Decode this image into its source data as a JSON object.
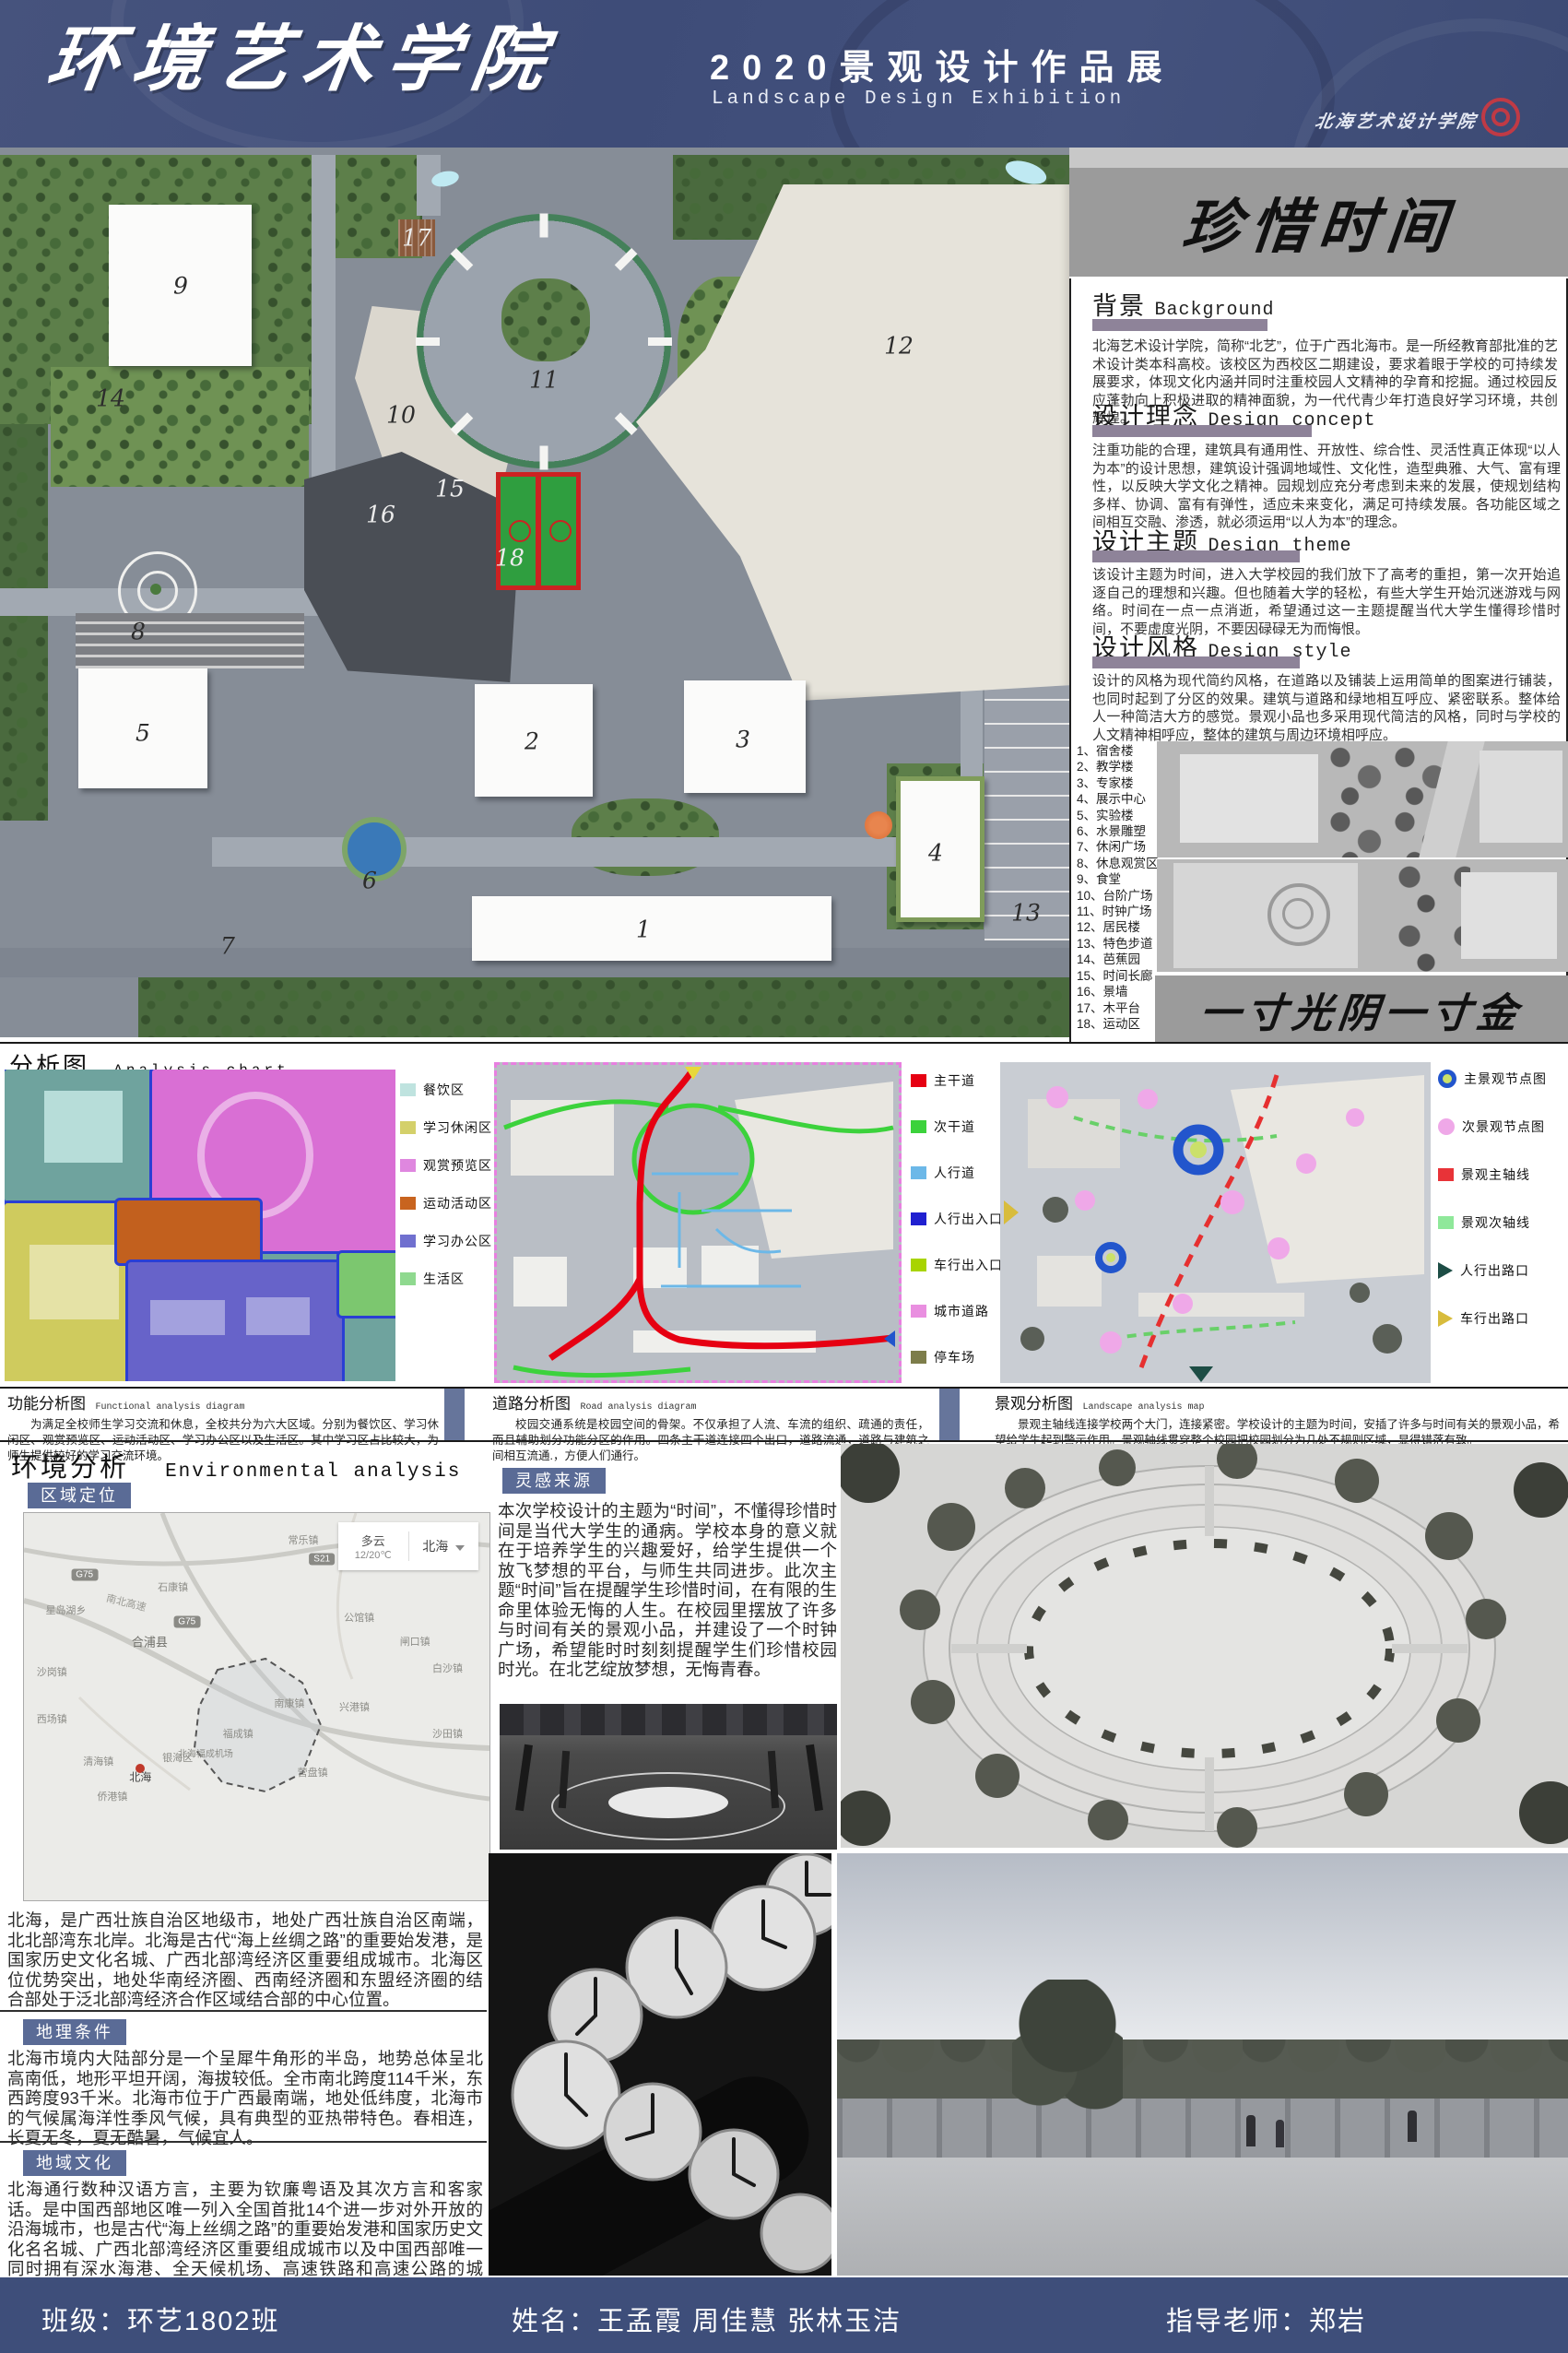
{
  "header": {
    "school_title": "环境艺术学院",
    "exhibition_title": "2020景观设计作品展",
    "exhibition_subtitle": "Landscape Design Exhibition",
    "logo_text": "北海艺术设计学院",
    "bg_color": "#3e4e78"
  },
  "theme": {
    "main_title": "珍惜时间",
    "motto": "一寸光阴一寸金"
  },
  "sections": {
    "background": {
      "title": "背景",
      "subtitle": "Background",
      "body": "北海艺术设计学院，简称“北艺”，位于广西北海市。是一所经教育部批准的艺术设计类本科高校。该校区为西校区二期建设，要求着眼于学校的可持续发展要求，体现文化内涵并同时注重校园人文精神的孕育和挖掘。通过校园反应蓬勃向上积极进取的精神面貌，为一代代青少年打造良好学习环境，共创辉煌。"
    },
    "concept": {
      "title": "设计理念",
      "subtitle": "Design concept",
      "body": "注重功能的合理，建筑具有通用性、开放性、综合性、灵活性真正体现“以人为本”的设计思想，建筑设计强调地域性、文化性，造型典雅、大气、富有理性，以反映大学文化之精神。园规划应充分考虑到未来的发展，使规划结构多样、协调、富有有弹性，适应未来变化，满足可持续发展。各功能区域之间相互交融、渗透，就必须运用“以人为本”的理念。"
    },
    "design_theme": {
      "title": "设计主题",
      "subtitle": "Design theme",
      "body": "该设计主题为时间，进入大学校园的我们放下了高考的重担，第一次开始追逐自己的理想和兴趣。但也随着大学的轻松，有些大学生开始沉迷游戏与网络。时间在一点一点消逝，希望通过这一主题提醒当代大学生懂得珍惜时间，不要虚度光阴，不要因碌碌无为而悔恨。"
    },
    "style": {
      "title": "设计风格",
      "subtitle": "Design style",
      "body": "设计的风格为现代简约风格，在道路以及铺装上运用简单的图案进行铺装，也同时起到了分区的效果。建筑与道路和绿地相互呼应、紧密联系。整体给人一种简洁大方的感觉。景观小品也多采用现代简洁的风格，同时与学校的人文精神相呼应，整体的建筑与周边环境相呼应。"
    }
  },
  "plan": {
    "markers": [
      "1",
      "2",
      "3",
      "4",
      "5",
      "6",
      "7",
      "8",
      "9",
      "10",
      "11",
      "12",
      "13",
      "14",
      "15",
      "16",
      "17",
      "18"
    ],
    "legend": [
      "1、宿舍楼",
      "2、教学楼",
      "3、专家楼",
      "4、展示中心",
      "5、实验楼",
      "6、水景雕塑",
      "7、休闲广场",
      "8、休息观赏区",
      "9、食堂",
      "10、台阶广场",
      "11、时钟广场",
      "12、居民楼",
      "13、特色步道",
      "14、芭蕉园",
      "15、时间长廊",
      "16、景墙",
      "17、木平台",
      "18、运动区"
    ]
  },
  "analysis": {
    "title": "分析图",
    "subtitle": "Analysis chart",
    "functional_legend": [
      {
        "label": "餐饮区",
        "color": "#bfe3df"
      },
      {
        "label": "学习休闲区",
        "color": "#d4d06a"
      },
      {
        "label": "观赏预览区",
        "color": "#df87df"
      },
      {
        "label": "运动活动区",
        "color": "#c8641f"
      },
      {
        "label": "学习办公区",
        "color": "#7070cf"
      },
      {
        "label": "生活区",
        "color": "#8fd98f"
      }
    ],
    "road_legend": [
      {
        "label": "主干道",
        "color": "#e60012"
      },
      {
        "label": "次干道",
        "color": "#3cd23c"
      },
      {
        "label": "人行道",
        "color": "#6cb8e8"
      },
      {
        "label": "人行出入口",
        "color": "#2020d0"
      },
      {
        "label": "车行出入口",
        "color": "#a8d400"
      },
      {
        "label": "城市道路",
        "color": "#e98fe0"
      },
      {
        "label": "停车场",
        "color": "#7d7d4a"
      }
    ],
    "landscape_legend": [
      {
        "label": "主景观节点图",
        "color": "#2255cc"
      },
      {
        "label": "次景观节点图",
        "color": "#efa8e8"
      },
      {
        "label": "景观主轴线",
        "color": "#e83338"
      },
      {
        "label": "景观次轴线",
        "color": "#8fe89a"
      },
      {
        "label": "人行出路口",
        "color": "#1d4d45"
      },
      {
        "label": "车行出路口",
        "color": "#d8bc3c"
      }
    ],
    "captions": [
      {
        "title": "功能分析图",
        "subtitle": "Functional analysis diagram",
        "body": "为满足全校师生学习交流和休息，全校共分为六大区域。分别为餐饮区、学习休闲区、观赏预览区、运动活动区、学习办公区以及生活区。其中学习区占比较大，为师生提供较好的学习交流环境。"
      },
      {
        "title": "道路分析图",
        "subtitle": "Road analysis diagram",
        "body": "校园交通系统是校园空间的骨架。不仅承担了人流、车流的组织、疏通的责任，而且辅助划分功能分区的作用。四条主干道连接四个出口，道路流通，道路与建筑之间相互流通.，方便人们通行。"
      },
      {
        "title": "景观分析图",
        "subtitle": "Landscape analysis map",
        "body": "景观主轴线连接学校两个大门，连接紧密。学校设计的主题为时间，安插了许多与时间有关的景观小品，希望给学生起到警示作用。景观轴线贯穿整个校园把校园划分为几处不规则区域，显得错落有致。"
      }
    ]
  },
  "environment": {
    "title": "环境分析",
    "subtitle": "Environmental analysis",
    "region_label": "区域定位",
    "inspiration_label": "灵感来源",
    "inspiration_body": "本次学校设计的主题为“时间”，不懂得珍惜时间是当代大学生的通病。学校本身的意义就在于培养学生的兴趣爱好，给学生提供一个放飞梦想的平台，与师生共同进步。此次主题“时间”旨在提醒学生珍惜时间，在有限的生命里体验无悔的人生。在校园里摆放了许多与时间有关的景观小品，并建设了一个时钟广场，希望能时时刻刻提醒学生们珍惜校园时光。在北艺绽放梦想，无悔青春。",
    "map": {
      "weather": {
        "condition": "多云",
        "temp": "12/20℃",
        "city": "北海"
      },
      "highway_label": "南北高速",
      "badges": [
        "G75",
        "G75",
        "S21"
      ],
      "towns": [
        {
          "name": "常乐镇",
          "x": 60,
          "y": 7
        },
        {
          "name": "石康镇",
          "x": 32,
          "y": 19
        },
        {
          "name": "星岛湖乡",
          "x": 9,
          "y": 25
        },
        {
          "name": "合浦县",
          "x": 27,
          "y": 33
        },
        {
          "name": "沙岗镇",
          "x": 4,
          "y": 41
        },
        {
          "name": "公馆镇",
          "x": 72,
          "y": 27
        },
        {
          "name": "闸口镇",
          "x": 84,
          "y": 33
        },
        {
          "name": "白沙镇",
          "x": 91,
          "y": 40
        },
        {
          "name": "西场镇",
          "x": 4,
          "y": 53
        },
        {
          "name": "南康镇",
          "x": 57,
          "y": 49
        },
        {
          "name": "兴港镇",
          "x": 71,
          "y": 50
        },
        {
          "name": "福成镇",
          "x": 46,
          "y": 57
        },
        {
          "name": "北海福成机场",
          "x": 39,
          "y": 62
        },
        {
          "name": "沙田镇",
          "x": 91,
          "y": 57
        },
        {
          "name": "营盘镇",
          "x": 62,
          "y": 67
        },
        {
          "name": "清海镇",
          "x": 16,
          "y": 64
        },
        {
          "name": "侨港镇",
          "x": 19,
          "y": 73
        },
        {
          "name": "北海",
          "x": 24,
          "y": 66
        },
        {
          "name": "银海区",
          "x": 33,
          "y": 63
        }
      ]
    },
    "intro_body": "北海，是广西壮族自治区地级市，地处广西壮族自治区南端，北北部湾东北岸。北海是古代“海上丝绸之路”的重要始发港，是国家历史文化名城、广西北部湾经济区重要组成城市。北海区位优势突出，地处华南经济圈、西南经济圈和东盟经济圈的结合部处于泛北部湾经济合作区域结合部的中心位置。",
    "geo_label": "地理条件",
    "geo_body": "北海市境内大陆部分是一个呈犀牛角形的半岛，地势总体呈北高南低，地形平坦开阔，海拔较低。全市南北跨度114千米，东西跨度93千米。北海市位于广西最南端，地处低纬度，北海市的气候属海洋性季风气候，具有典型的亚热带特色。春相连，长夏无冬，夏无酷暑，气候宜人。",
    "culture_label": "地域文化",
    "culture_body": "北海通行数种汉语方言，主要为钦廉粤语及其次方言和客家话。是中国西部地区唯一列入全国首批14个进一步对外开放的沿海城市，也是古代“海上丝绸之路”的重要始发港和国家历史文化名名城、广西北部湾经济区重要组成城市以及中国西部唯一同时拥有深水海港、全天候机场、高速铁路和高速公路的城市。"
  },
  "footer": {
    "class_label": "班级：环艺1802班",
    "names_label": "姓名：王孟霞  周佳慧  张林玉洁",
    "teacher_label": "指导老师：郑岩"
  }
}
